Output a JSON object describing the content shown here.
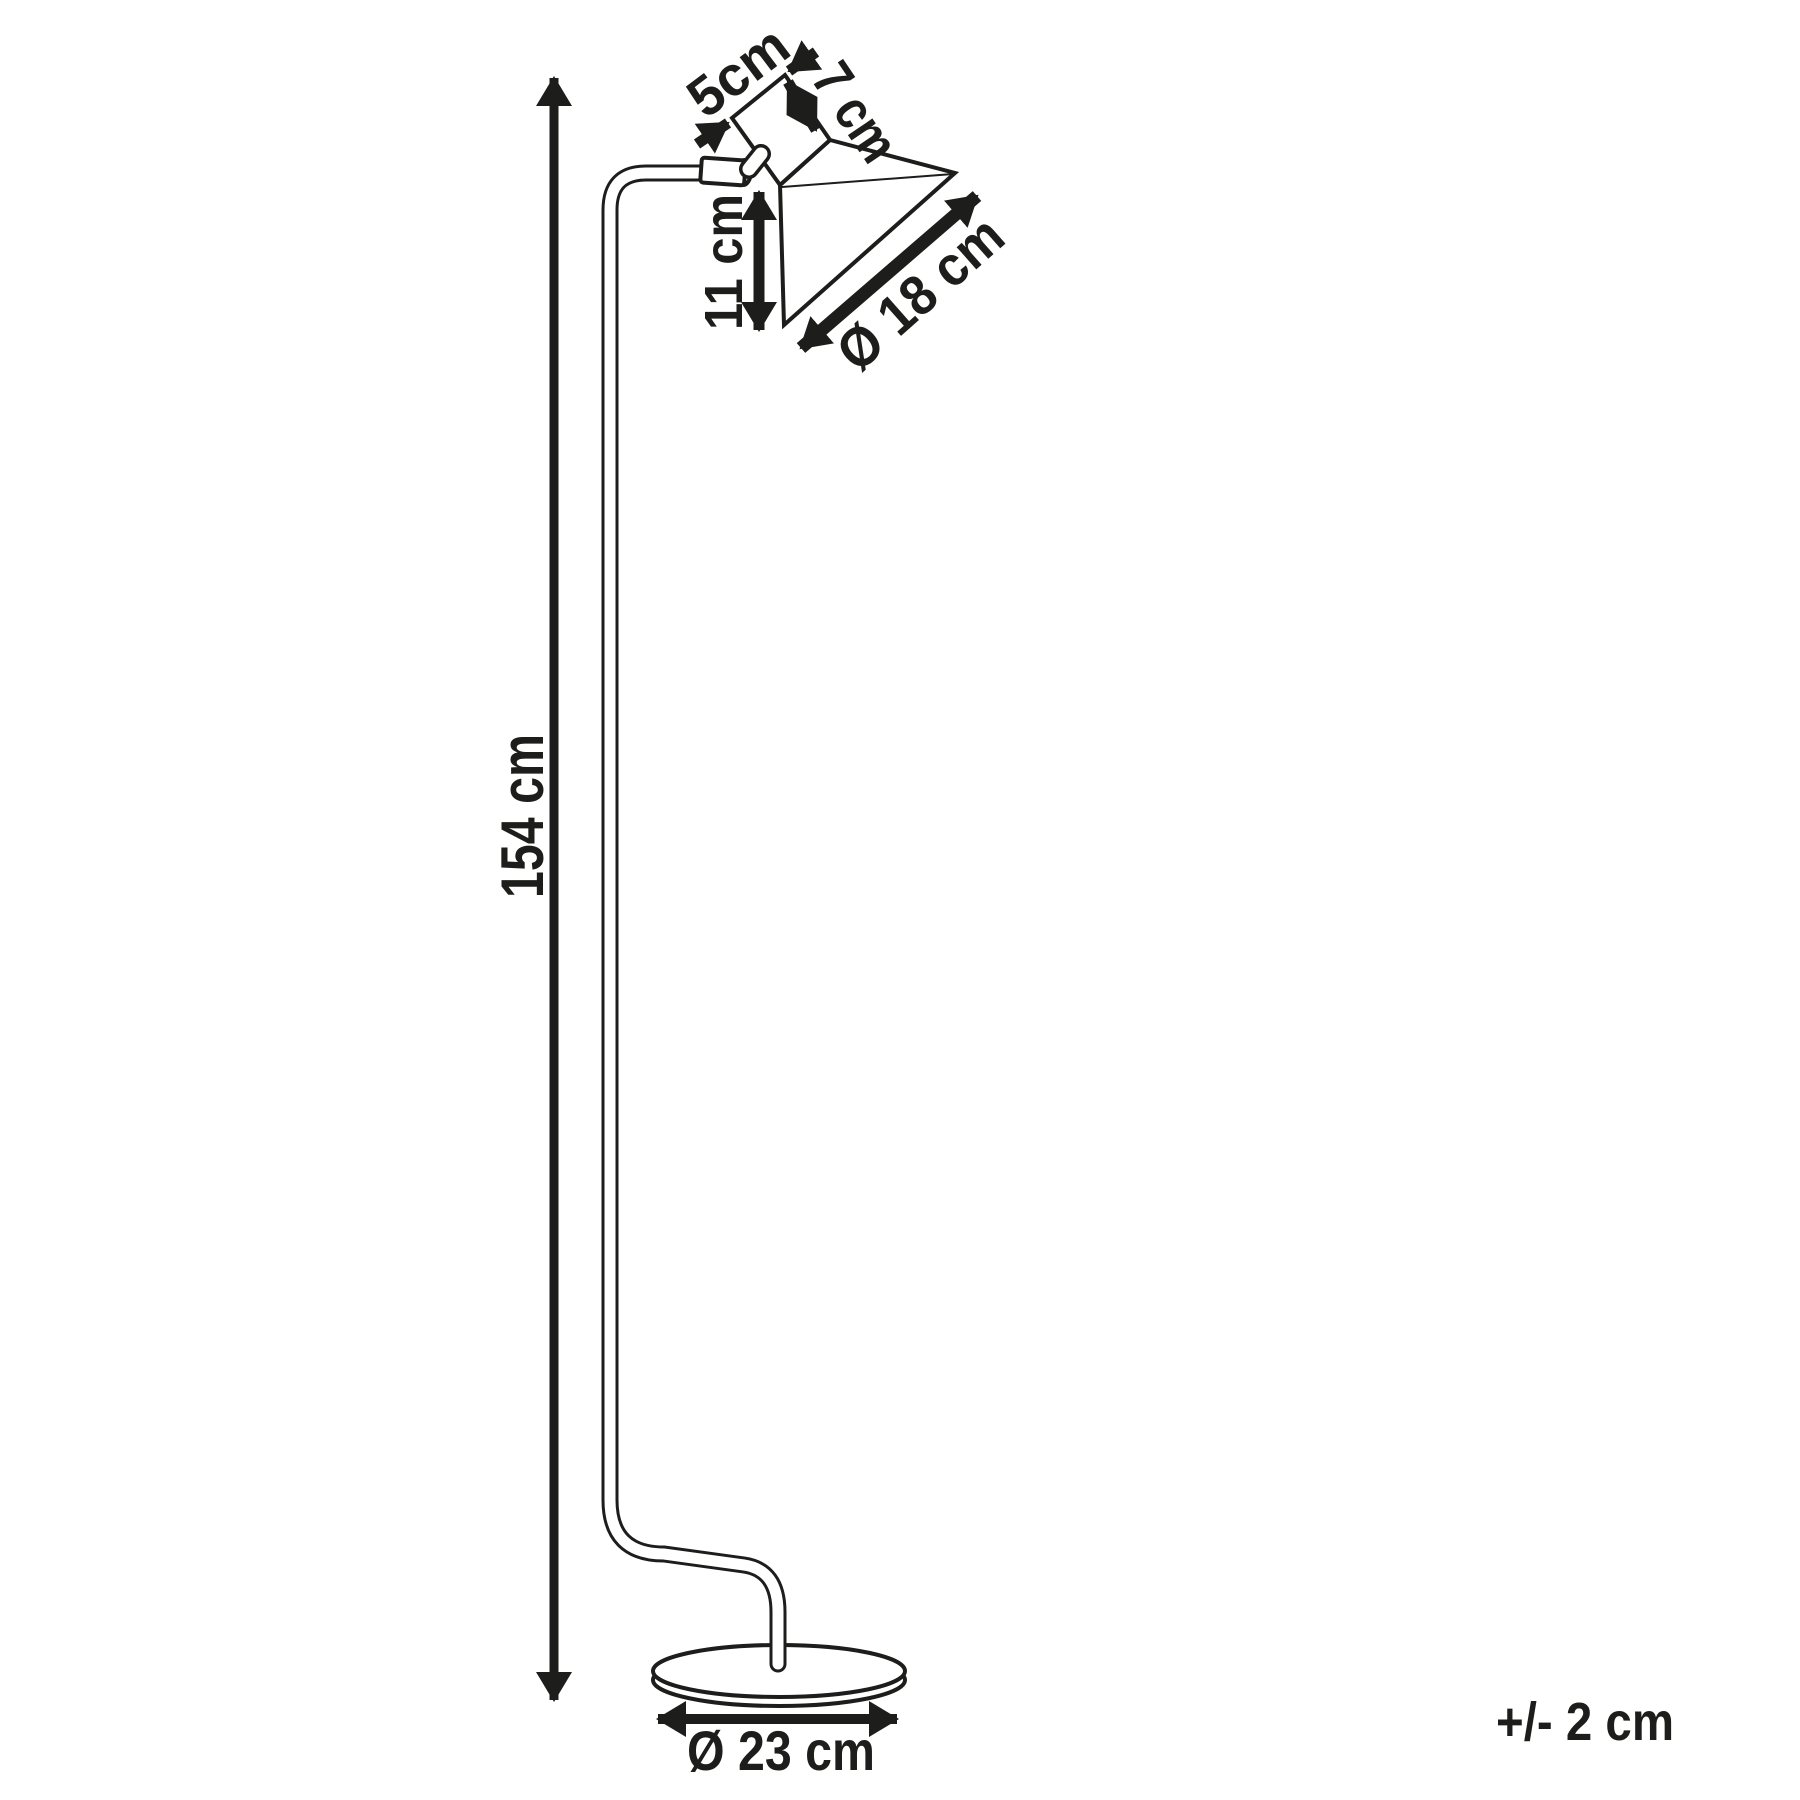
{
  "page": {
    "background_color": "#ffffff",
    "line_color": "#1d1d1b",
    "figure": "floor-lamp-dimension-line-drawing"
  },
  "dimensions": {
    "lamp_height": "154 cm",
    "shade_top_width": "5cm",
    "shade_top_depth": "7 cm",
    "shade_height": "11 cm",
    "shade_opening_diameter": "Ø 18 cm",
    "base_diameter": "Ø 23 cm",
    "tolerance": "+/- 2 cm"
  }
}
